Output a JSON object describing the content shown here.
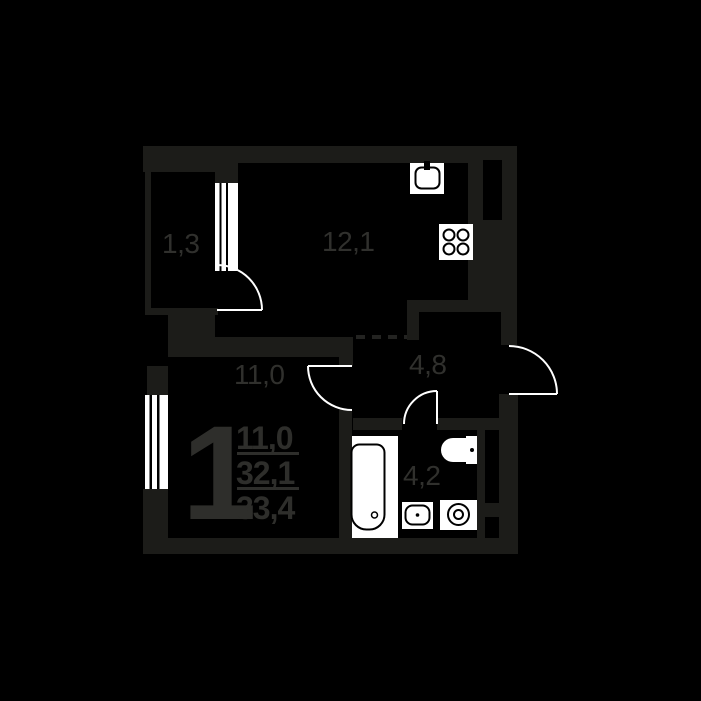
{
  "floorplan": {
    "type": "apartment-floor-plan",
    "rooms": [
      {
        "id": "balcony",
        "area_label": "1,3"
      },
      {
        "id": "kitchen-living",
        "area_label": "12,1"
      },
      {
        "id": "bedroom",
        "area_label": "11,0"
      },
      {
        "id": "hallway",
        "area_label": "4,8"
      },
      {
        "id": "bathroom",
        "area_label": "4,2"
      }
    ],
    "summary": {
      "rooms_count": "1",
      "living_area": "11,0",
      "area_without_balcony": "32,1",
      "total_area": "33,4"
    },
    "fixtures": [
      "kitchen-sink-icon",
      "stove-icon",
      "bathtub-icon",
      "toilet-icon",
      "washbasin-icon",
      "washing-machine-icon"
    ],
    "openings": [
      "balcony-door-arc",
      "room-door-arc",
      "bathroom-door-arc",
      "entrance-door-arc",
      "kitchen-open-passage-dashed"
    ],
    "colors": {
      "background": "#000000",
      "wall": "#1c1c19",
      "label_text": "#30302d",
      "summary_text": "#2e2e2b",
      "fixture_white": "#ffffff",
      "dashed_line": "#232321"
    }
  }
}
